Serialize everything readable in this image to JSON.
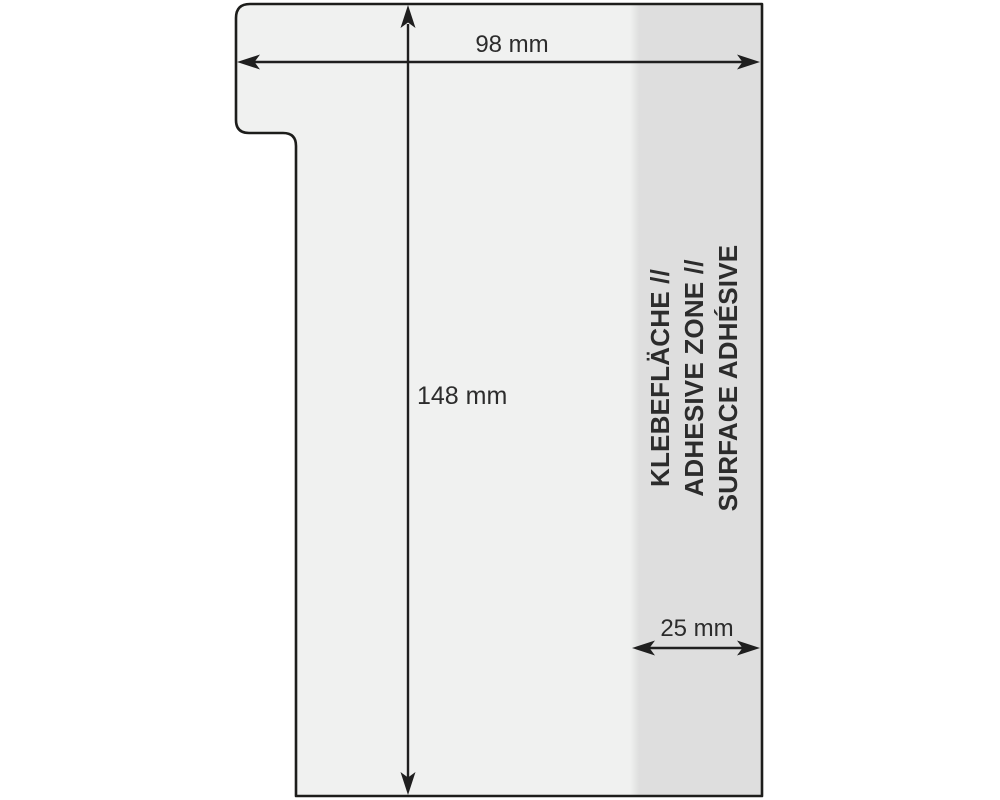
{
  "diagram_title": "t-card-pocket-dimension-diagram",
  "labels": {
    "width": "98 mm",
    "height": "148 mm",
    "adhesive_width": "25 mm"
  },
  "adhesive_text": {
    "line1": "KLEBEFLÄCHE //",
    "line2": "ADHESIVE ZONE //",
    "line3": "SURFACE ADHÉSIVE"
  },
  "measurements": {
    "width_mm": 98,
    "height_mm": 148,
    "adhesive_zone_width_mm": 25
  },
  "colors": {
    "background": "#ffffff",
    "card_fill": "#f0f1f0",
    "adhesive_fill": "#dedede",
    "outline": "#1d1d1b",
    "dimension": "#1f1f1f",
    "label_color": "#2c2c2c"
  }
}
